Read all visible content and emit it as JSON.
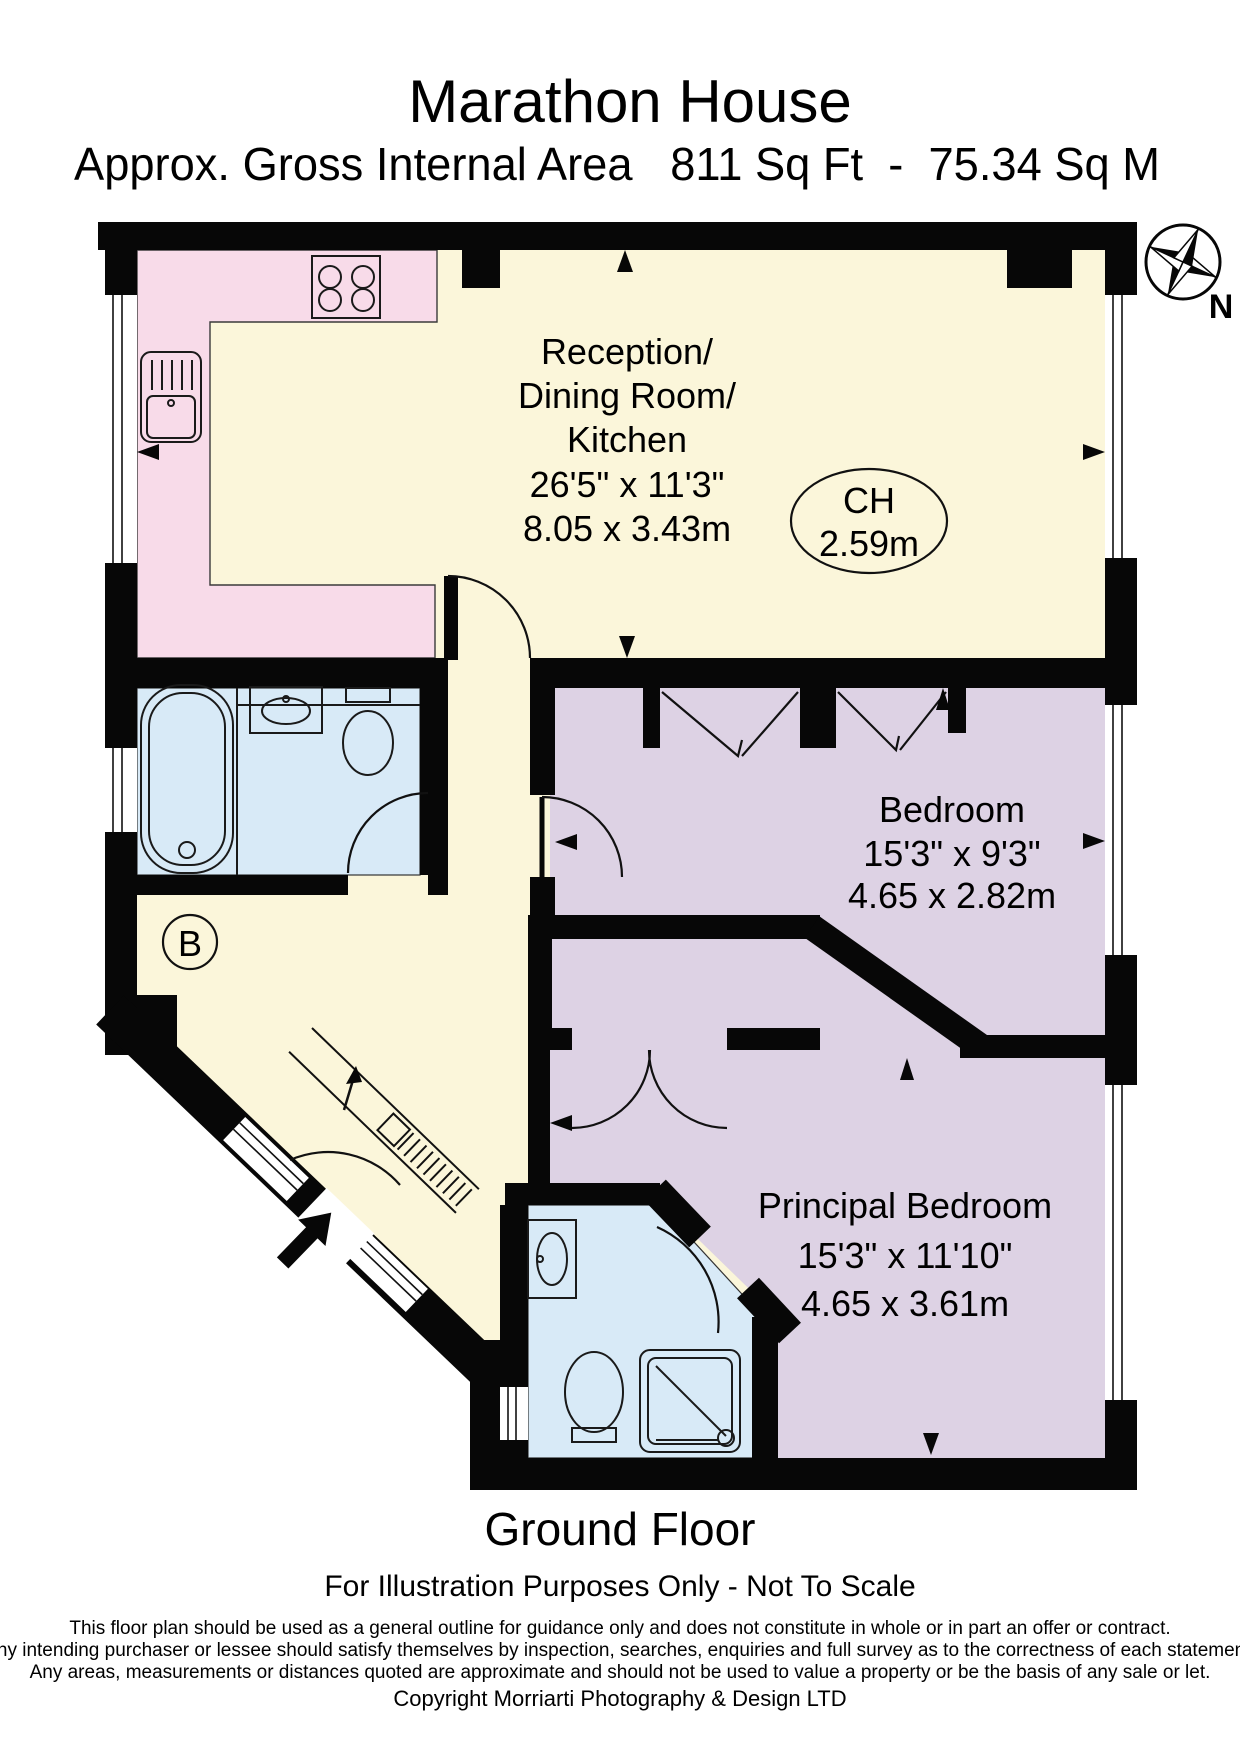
{
  "header": {
    "title": "Marathon House",
    "subtitle": "Approx. Gross Internal Area   811 Sq Ft  -  75.34 Sq M"
  },
  "compass": {
    "north_label": "N"
  },
  "rooms": {
    "reception": {
      "lines": [
        "Reception/",
        "Dining Room/",
        "Kitchen",
        "26'5\" x 11'3\"",
        "8.05 x 3.43m"
      ]
    },
    "ceiling_height": {
      "label": "CH",
      "value": "2.59m"
    },
    "bedroom": {
      "lines": [
        "Bedroom",
        "15'3\" x 9'3\"",
        "4.65 x 2.82m"
      ]
    },
    "principal_bedroom": {
      "lines": [
        "Principal Bedroom",
        "15'3\" x 11'10\"",
        "4.65 x 3.61m"
      ]
    },
    "boiler_label": "B"
  },
  "footer": {
    "floor_label": "Ground Floor",
    "scale_note": "For Illustration Purposes Only - Not To Scale",
    "disclaimer": [
      "This floor plan should be used as a general outline for guidance only and does not constitute in whole or in part an offer or contract.",
      "Any intending purchaser or lessee should satisfy themselves by inspection, searches, enquiries and full survey as to the correctness of each statement.",
      "Any areas, measurements or distances quoted are approximate and should not be used to value a property or be the basis of any sale or let."
    ],
    "copyright": "Copyright Morriarti Photography & Design LTD"
  },
  "colors": {
    "wall": "#070707",
    "reception_fill": "#FBF6DA",
    "kitchen_fill": "#F8DBE9",
    "bathroom_fill": "#D8EAF7",
    "bedroom_fill": "#DDD2E4",
    "outline": "#333333"
  }
}
